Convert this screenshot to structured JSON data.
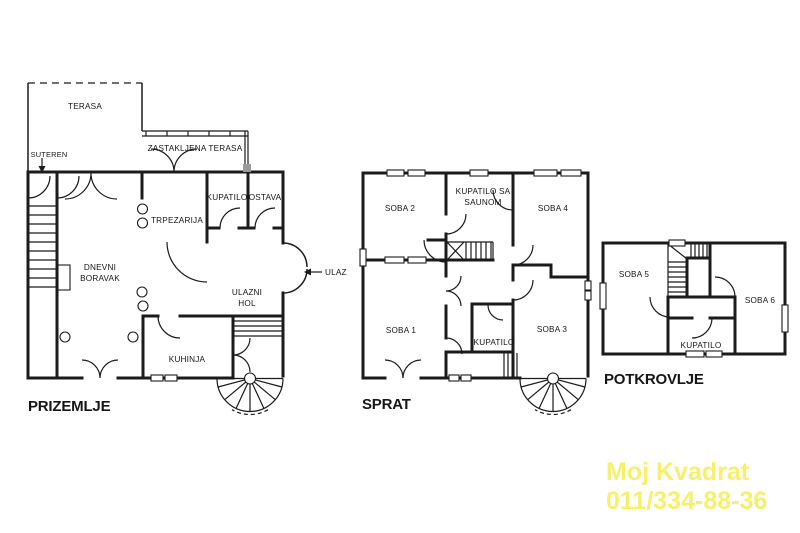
{
  "palette": {
    "line": "#1b1b1b",
    "text": "#161616",
    "background": "#ffffff"
  },
  "watermark": {
    "line1": "Moj Kvadrat",
    "line2": "011/334-88-36",
    "color": "#F7F06C"
  },
  "plans": {
    "prizemlje": {
      "title": "PRIZEMLJE",
      "rooms": {
        "terasa": "TERASA",
        "suteren": "SUTEREN",
        "zastakljena_terasa": "ZASTAKLJENA TERASA",
        "kupatilo": "KUPATILO",
        "ostava": "OSTAVA",
        "trpezarija": "TRPEZARIJA",
        "dnevni_line1": "DNEVNI",
        "dnevni_line2": "BORAVAK",
        "hol_line1": "ULAZNI",
        "hol_line2": "HOL",
        "kuhinja": "KUHINJA",
        "ulaz": "ULAZ"
      }
    },
    "sprat": {
      "title": "SPRAT",
      "rooms": {
        "soba2": "SOBA 2",
        "sauna_line1": "KUPATILO SA",
        "sauna_line2": "SAUNOM",
        "soba4": "SOBA 4",
        "soba1": "SOBA 1",
        "kupatilo": "KUPATILO",
        "soba3": "SOBA 3"
      }
    },
    "potkrovlje": {
      "title": "POTKROVLJE",
      "rooms": {
        "soba5": "SOBA 5",
        "soba6": "SOBA 6",
        "kupatilo": "KUPATILO"
      }
    }
  }
}
